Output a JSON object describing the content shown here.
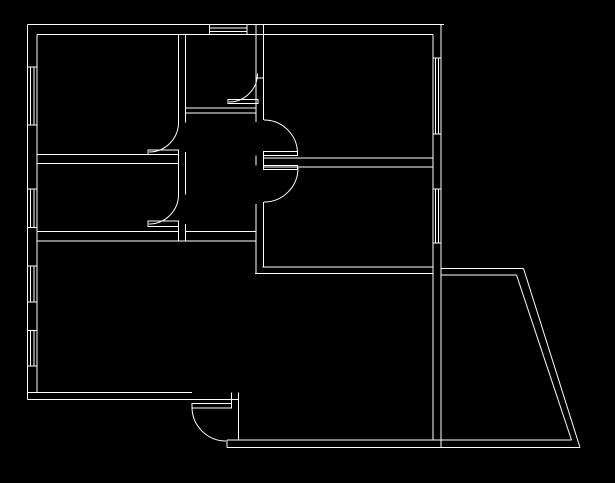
{
  "canvas": {
    "width": 615,
    "height": 483,
    "background_color": "#000000",
    "line_color": "#ffffff",
    "line_width": 1,
    "description": "apartment-floor-plan-line-drawing"
  },
  "floor_plan": {
    "walls": {
      "h_segments": [
        [
          24.5,
          27.5,
          444
        ],
        [
          34.5,
          37,
          433
        ],
        [
          154.5,
          37,
          148
        ],
        [
          163.5,
          37,
          178.5
        ],
        [
          231.5,
          37,
          178
        ],
        [
          231.5,
          185.5,
          255.5
        ],
        [
          241,
          37,
          255.5
        ],
        [
          108,
          185.5,
          256.5
        ],
        [
          113,
          185.5,
          256.5
        ],
        [
          78,
          256,
          263.5
        ],
        [
          158,
          263.5,
          433
        ],
        [
          167,
          263.5,
          433
        ],
        [
          267,
          262.5,
          433
        ],
        [
          273.5,
          255,
          433
        ],
        [
          268.5,
          441,
          523.5
        ],
        [
          275,
          441,
          516.5
        ],
        [
          392.5,
          27.5,
          192
        ],
        [
          399.5,
          27.5,
          238.5
        ],
        [
          440,
          227,
          571.5
        ],
        [
          447.5,
          227,
          580
        ]
      ],
      "v_segments": [
        [
          27.5,
          24.5,
          399.5
        ],
        [
          37,
          34.5,
          392.5
        ],
        [
          178.5,
          34.5,
          122.5
        ],
        [
          178.5,
          152,
          194.5
        ],
        [
          178.5,
          224,
          241
        ],
        [
          185.5,
          34.5,
          122.5
        ],
        [
          185.5,
          152,
          194.5
        ],
        [
          185.5,
          224,
          241
        ],
        [
          256,
          24.5,
          122
        ],
        [
          256,
          155.5,
          165.5
        ],
        [
          256,
          204,
          273.5
        ],
        [
          263.5,
          24.5,
          120
        ],
        [
          263.5,
          155.5,
          165.5
        ],
        [
          263.5,
          202,
          267
        ],
        [
          433,
          34.5,
          58
        ],
        [
          433,
          134,
          189
        ],
        [
          433,
          243,
          440
        ],
        [
          441,
          24.5,
          58
        ],
        [
          441,
          134,
          189
        ],
        [
          441,
          243,
          447.5
        ],
        [
          231.5,
          392.5,
          408
        ],
        [
          238.5,
          392.5,
          440
        ],
        [
          227,
          440,
          447.5
        ]
      ],
      "slant_segments": [
        [
          523.5,
          268.5,
          580,
          447.5
        ],
        [
          516.5,
          275,
          571.5,
          440
        ]
      ]
    },
    "doors": [
      {
        "id": "top-left-room-door",
        "leaf": [
          148,
          150,
          178.5,
          154.5
        ],
        "arc": "M 149 152 A 29.5 29.5 0 0 0 178.5 122.5"
      },
      {
        "id": "left-middle-room-door",
        "leaf": [
          148,
          221,
          178.5,
          226.5
        ],
        "arc": "M 149 224 A 29.5 29.5 0 0 0 178.5 194.5"
      },
      {
        "id": "top-middle-room-door",
        "leaf": [
          228,
          99.5,
          258,
          103.5
        ],
        "arc": "M 229 102 A 28.5 28.5 0 0 0 257.5 73.5"
      },
      {
        "id": "top-right-room-door",
        "leaf": [
          263.5,
          151.5,
          297.5,
          155.5
        ],
        "arc": "M 264 120 A 33.5 33.5 0 0 1 297.5 153.5"
      },
      {
        "id": "bottom-right-room-door",
        "leaf": [
          263.5,
          165.5,
          297.5,
          169.5
        ],
        "arc": "M 298 168 A 34 34 0 0 1 264 202"
      },
      {
        "id": "entrance-door",
        "leaf": [
          192,
          403.5,
          231.5,
          408
        ],
        "arc": "M 192 407 A 34 34 0 0 0 226 441"
      }
    ],
    "windows": [
      {
        "id": "top-wall-window",
        "dir": "h",
        "x1": 209.5,
        "x2": 247,
        "y1": 24.5,
        "y2": 34.7,
        "lines": 4
      },
      {
        "id": "left-wall-window-1",
        "dir": "v",
        "x1": 27.5,
        "x2": 37,
        "y1": 67,
        "y2": 125,
        "lines": 4
      },
      {
        "id": "left-wall-window-2",
        "dir": "v",
        "x1": 27.5,
        "x2": 37,
        "y1": 189,
        "y2": 227.5,
        "lines": 4
      },
      {
        "id": "left-wall-window-3",
        "dir": "v",
        "x1": 27.5,
        "x2": 37,
        "y1": 266,
        "y2": 302,
        "lines": 4
      },
      {
        "id": "left-wall-window-4",
        "dir": "v",
        "x1": 27.5,
        "x2": 37,
        "y1": 330.5,
        "y2": 366,
        "lines": 4
      },
      {
        "id": "right-wall-window-1",
        "dir": "v",
        "x1": 433,
        "x2": 441,
        "y1": 58,
        "y2": 134,
        "lines": 4
      },
      {
        "id": "right-wall-window-2",
        "dir": "v",
        "x1": 433,
        "x2": 441,
        "y1": 189,
        "y2": 243,
        "lines": 4
      }
    ]
  }
}
